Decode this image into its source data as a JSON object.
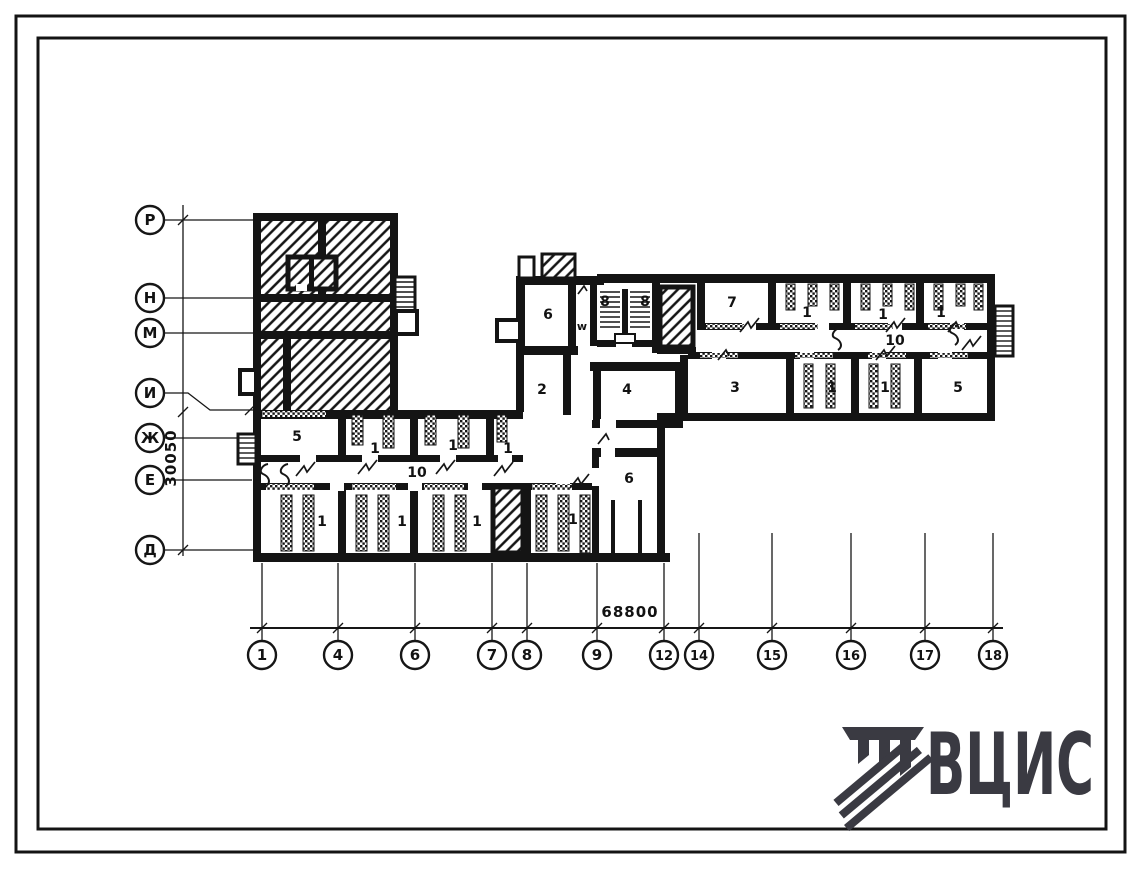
{
  "sheet": {
    "background": "#ffffff",
    "ink": "#141414",
    "logo_color": "#3a3a42"
  },
  "axes": {
    "rows": [
      {
        "label": "Р"
      },
      {
        "label": "Н"
      },
      {
        "label": "М"
      },
      {
        "label": "И"
      },
      {
        "label": "Ж"
      },
      {
        "label": "Е"
      },
      {
        "label": "Д"
      }
    ],
    "cols": [
      {
        "label": "1"
      },
      {
        "label": "4"
      },
      {
        "label": "6"
      },
      {
        "label": "7"
      },
      {
        "label": "8"
      },
      {
        "label": "9"
      },
      {
        "label": "12"
      },
      {
        "label": "14"
      },
      {
        "label": "15"
      },
      {
        "label": "16"
      },
      {
        "label": "17"
      },
      {
        "label": "18"
      }
    ]
  },
  "dimensions": {
    "overall_width": "68800",
    "overall_height": "30050"
  },
  "plan": {
    "labels": [
      {
        "text": "5"
      },
      {
        "text": "1"
      },
      {
        "text": "1"
      },
      {
        "text": "1"
      },
      {
        "text": "10"
      },
      {
        "text": "1"
      },
      {
        "text": "1"
      },
      {
        "text": "1"
      },
      {
        "text": "1"
      },
      {
        "text": "6"
      },
      {
        "text": "6"
      },
      {
        "text": "8"
      },
      {
        "text": "8"
      },
      {
        "text": "w"
      },
      {
        "text": "2"
      },
      {
        "text": "4"
      },
      {
        "text": "7"
      },
      {
        "text": "1"
      },
      {
        "text": "1"
      },
      {
        "text": "1"
      },
      {
        "text": "10"
      },
      {
        "text": "3"
      },
      {
        "text": "1"
      },
      {
        "text": "1"
      },
      {
        "text": "5"
      }
    ]
  },
  "logo": {
    "text": "ВЦИС"
  }
}
